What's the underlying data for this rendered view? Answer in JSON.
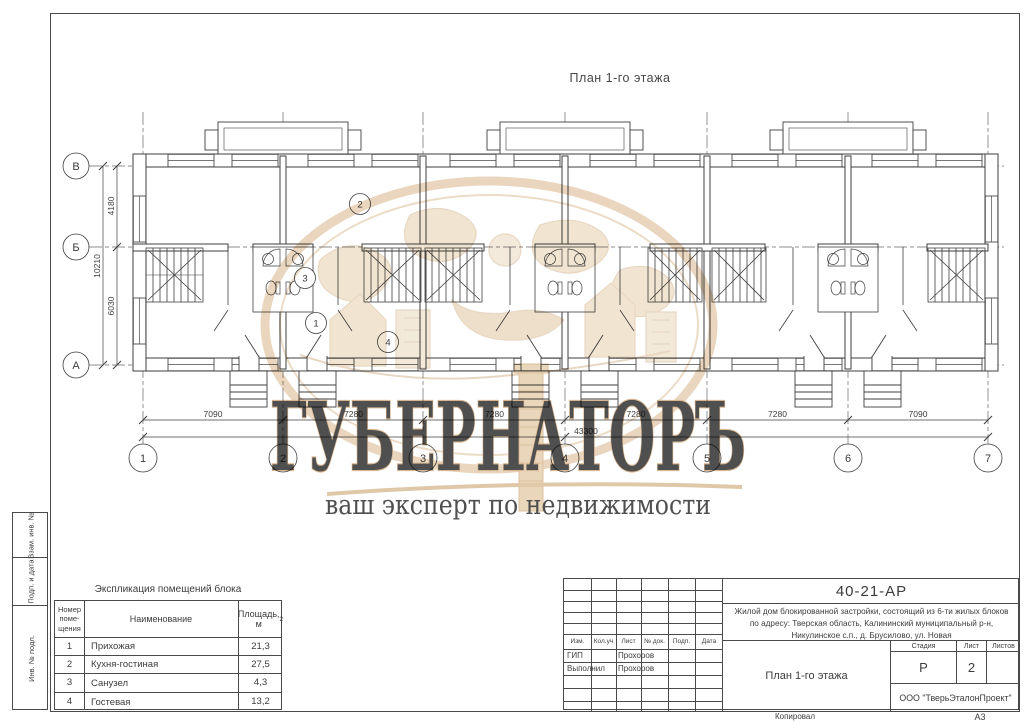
{
  "page_title": "План 1-го этажа",
  "watermark": {
    "brand": "ГУБЕРНАТОРЪ",
    "tagline": "ваш эксперт по недвижимости",
    "beige": "#e6cfae",
    "outline": "#d3ad83",
    "tagline_color": "#e9b3a4"
  },
  "plan": {
    "row_axes": [
      "В",
      "Б",
      "А"
    ],
    "col_axes": [
      "1",
      "2",
      "3",
      "4",
      "5",
      "6",
      "7"
    ],
    "dims_bottom": [
      "7090",
      "7280",
      "7280",
      "7280",
      "7280",
      "7090"
    ],
    "dim_total": "43300",
    "dims_left": [
      "4180",
      "6030"
    ],
    "dim_left_total": "10210",
    "room_tags": [
      "1",
      "2",
      "3",
      "4"
    ]
  },
  "explication": {
    "title": "Экспликация помещений блока",
    "header_num_l1": "Номер",
    "header_num_l2": "поме-",
    "header_num_l3": "щения",
    "header_name": "Наименование",
    "header_area": "Площадь, м",
    "header_area_sup": "2",
    "rows": [
      {
        "num": "1",
        "name": "Прихожая",
        "area": "21,3"
      },
      {
        "num": "2",
        "name": "Кухня-гостиная",
        "area": "27,5"
      },
      {
        "num": "3",
        "name": "Санузел",
        "area": "4,3"
      },
      {
        "num": "4",
        "name": "Гостевая",
        "area": "13,2"
      }
    ]
  },
  "stamp": {
    "code": "40-21-АР",
    "desc_line1": "Жилой дом блокированной застройки, состоящий из 6-ти жилых блоков",
    "desc_line2": "по адресу: Тверская область, Калининский муниципальный р-н,",
    "desc_line3": "Никулинское с.п., д. Брусилово, ул. Новая",
    "col_izm": "Изм.",
    "col_kol": "Кол.уч",
    "col_list": "Лист",
    "col_doc": "№ док.",
    "col_podp": "Подп.",
    "col_data": "Дата",
    "roles": [
      {
        "role": "ГИП",
        "name": "Прохоров"
      },
      {
        "role": "Выполнил",
        "name": "Прохоров"
      }
    ],
    "stage_label": "Стадия",
    "sheet_label": "Лист",
    "sheets_label": "Листов",
    "stage": "Р",
    "sheet": "2",
    "drawing_title": "План 1-го этажа",
    "company": "ООО \"ТверьЭталонПроект\""
  },
  "frame_sidebar": [
    "Взам. инв. №",
    "Подп. и дата",
    "Инв. № подл."
  ],
  "footer": {
    "copied": "Копировал",
    "format": "А3"
  }
}
